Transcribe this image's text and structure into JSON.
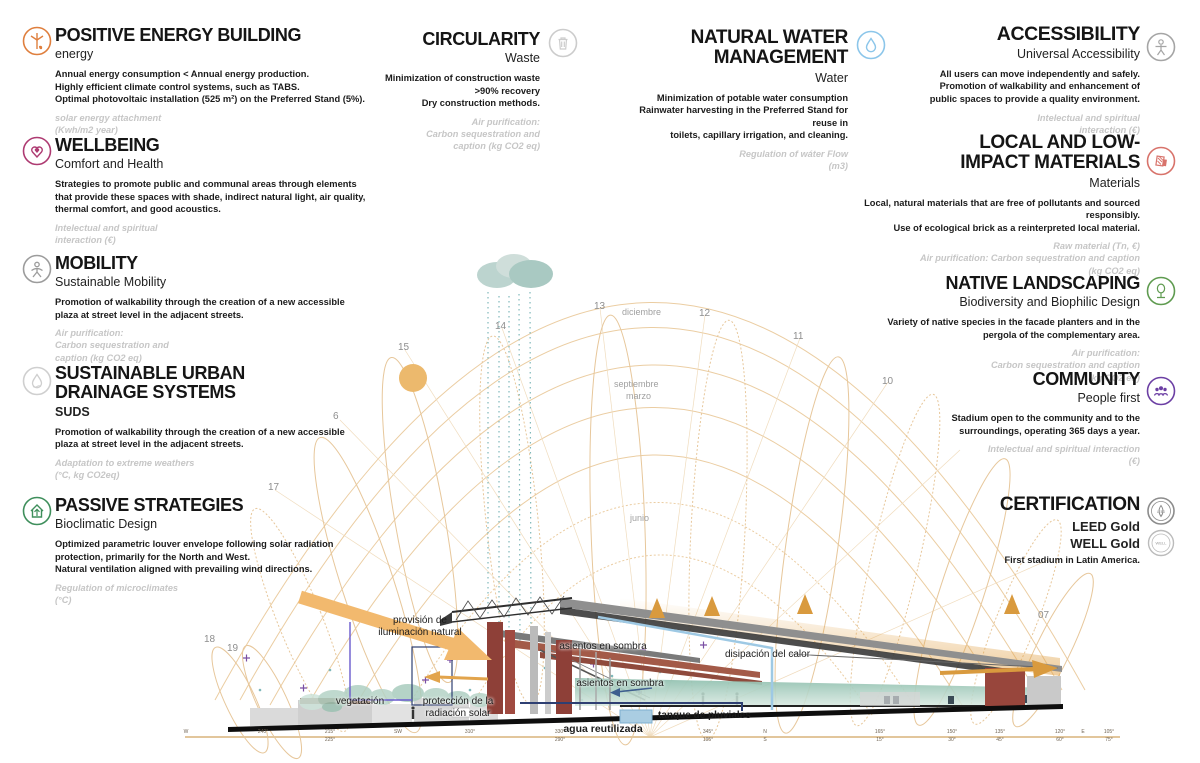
{
  "colors": {
    "energy": "#DF7F3E",
    "wellbeing": "#AE3B72",
    "mobility": "#9C9C9C",
    "suds": "#CFCFCF",
    "passive": "#3F8F5C",
    "circularity": "#CCCCCC",
    "water": "#8CC6EA",
    "accessibility": "#A5A5A5",
    "materials": "#D8736B",
    "landscaping": "#5F9B50",
    "community": "#6C3FA4",
    "certification": "#8C8C8C",
    "sunpath_arc": "#EBCDA2",
    "sun": "#ECB96D",
    "cloud": "#AECBC5",
    "rain": "#7FB8BA",
    "arrow_orange": "#E2A44C",
    "pipe_blue": "#9EC9E4",
    "pipe_navy": "#2E3F72",
    "teal_bowl": "#8FBFAE"
  },
  "sections": {
    "left": [
      {
        "title": "POSITIVE ENERGY BUILDING",
        "subtitle": "energy",
        "body": [
          "Annual energy consumption < Annual energy production.",
          "Highly efficient climate control systems, such as TABS.",
          "Optimal photovoltaic installation (525 m²) on the Preferred Stand (5%)."
        ],
        "metric": [
          "solar energy attachment",
          "(Kwh/m2 year)"
        ]
      },
      {
        "title": "WELLBEING",
        "subtitle": "Comfort and Health",
        "body": [
          "Strategies to promote public and communal areas through elements",
          "that provide these spaces with shade, indirect natural light, air quality,",
          "thermal comfort, and good acoustics."
        ],
        "metric": [
          "Intelectual and spiritual",
          "interaction (€)"
        ]
      },
      {
        "title": "MOBILITY",
        "subtitle": "Sustainable Mobility",
        "body": [
          "Promotion of walkability through the creation of a new accessible",
          "plaza at street level in the adjacent streets."
        ],
        "metric": [
          "Air purification:",
          "Carbon sequestration and",
          "caption (kg CO2 eq)"
        ]
      },
      {
        "title_lines": [
          "SUSTAINABLE URBAN",
          "DRAINAGE SYSTEMS"
        ],
        "subtitle": "SUDS",
        "body": [
          "Promotion of walkability through the creation of a new accessible",
          "plaza at street level in the adjacent streets."
        ],
        "metric": [
          "Adaptation to extreme weathers",
          "(°C, kg CO2eq)"
        ]
      },
      {
        "title": "PASSIVE STRATEGIES",
        "subtitle": "Bioclimatic Design",
        "body": [
          "Optimized parametric louver envelope following solar radiation",
          "protection, primarily for the North and West.",
          "Natural ventilation aligned with prevailing wind directions."
        ],
        "metric": [
          "Regulation of microclimates",
          "(°C)"
        ]
      }
    ],
    "center": [
      {
        "title": "CIRCULARITY",
        "subtitle": "Waste",
        "body": [
          "Minimization of construction waste",
          ">90% recovery",
          "Dry construction methods."
        ],
        "metric": [
          "Air purification:",
          "Carbon sequestration and",
          "caption (kg CO2 eq)"
        ]
      },
      {
        "title_lines": [
          "NATURAL WATER",
          "MANAGEMENT"
        ],
        "subtitle": "Water",
        "body": [
          "Minimization of potable water consumption",
          "Rainwater harvesting in the Preferred Stand for reuse in",
          "toilets, capillary irrigation, and cleaning."
        ],
        "metric": [
          "Regulation of wáter Flow",
          "(m3)"
        ]
      }
    ],
    "right": [
      {
        "title": "ACCESSIBILITY",
        "subtitle": "Universal Accessibility",
        "body": [
          "All users can move independently and safely.",
          "Promotion of walkability and enhancement of",
          "public spaces to provide a quality environment."
        ],
        "metric": [
          "Intelectual and spiritual",
          "interaction (€)"
        ]
      },
      {
        "title_lines": [
          "LOCAL AND LOW-",
          "IMPACT MATERIALS"
        ],
        "subtitle": "Materials",
        "body": [
          "Local, natural materials that are free of pollutants and sourced responsibly.",
          "Use of ecological brick as a reinterpreted local material."
        ],
        "metric": [
          "Raw material (Tn, €)",
          "Air purification: Carbon sequestration and caption",
          "(kg CO2 eq)"
        ]
      },
      {
        "title": "NATIVE LANDSCAPING",
        "subtitle": "Biodiversity and Biophilic Design",
        "body": [
          "Variety of native species in the facade planters and in the",
          "pergola of the complementary area."
        ],
        "metric": [
          "Air purification:",
          "Carbon sequestration and caption",
          "(kg CO2 eq)"
        ]
      },
      {
        "title": "COMMUNITY",
        "subtitle": "People first",
        "body": [
          "Stadium open to the community and to the",
          "surroundings, operating 365 days a year."
        ],
        "metric": [
          "Intelectual and spiritual interaction",
          "(€)"
        ]
      },
      {
        "title": "CERTIFICATION",
        "lines": [
          "LEED Gold",
          "WELL Gold"
        ],
        "note": "First stadium in Latin America.",
        "badges": [
          "LEED",
          "WELL"
        ]
      }
    ]
  },
  "diagram": {
    "labels": {
      "natural_light": [
        "provisión de",
        "iluminación natural"
      ],
      "shade_upper": "asientos en sombra",
      "shade_lower": "asientos en sombra",
      "heat": "disipación del calor",
      "protection": [
        "protección de la",
        "radiación solar"
      ],
      "vegetation": "vegetación",
      "tank": "tanque de pluviales",
      "reused_water": "agua reutilizada"
    },
    "months": [
      {
        "text": "diciembre",
        "x": 622,
        "y": 307
      },
      {
        "text": "septiembre",
        "x": 614,
        "y": 379
      },
      {
        "text": "marzo",
        "x": 626,
        "y": 391
      },
      {
        "text": "junio",
        "x": 630,
        "y": 513
      }
    ],
    "hours": [
      {
        "text": "6",
        "x": 333,
        "y": 411
      },
      {
        "text": "15",
        "x": 398,
        "y": 342
      },
      {
        "text": "14",
        "x": 495,
        "y": 321
      },
      {
        "text": "13",
        "x": 594,
        "y": 301
      },
      {
        "text": "12",
        "x": 699,
        "y": 308
      },
      {
        "text": "11",
        "x": 793,
        "y": 331
      },
      {
        "text": "10",
        "x": 882,
        "y": 376
      },
      {
        "text": "17",
        "x": 268,
        "y": 482
      },
      {
        "text": "18",
        "x": 204,
        "y": 634
      },
      {
        "text": "19",
        "x": 227,
        "y": 643
      },
      {
        "text": "07",
        "x": 1038,
        "y": 610
      }
    ],
    "compass_ticks": [
      {
        "x": 186,
        "top": "W",
        "bot": ""
      },
      {
        "x": 263,
        "top": "",
        "bot": "240°"
      },
      {
        "x": 330,
        "top": "215°",
        "bot": "225°"
      },
      {
        "x": 398,
        "top": "",
        "bot": "SW"
      },
      {
        "x": 470,
        "top": "310°",
        "bot": ""
      },
      {
        "x": 560,
        "top": "330°",
        "bot": "290°"
      },
      {
        "x": 708,
        "top": "345°",
        "bot": "195°"
      },
      {
        "x": 765,
        "top": "N",
        "bot": "S"
      },
      {
        "x": 880,
        "top": "165°",
        "bot": "15°"
      },
      {
        "x": 952,
        "top": "150°",
        "bot": "30°"
      },
      {
        "x": 1000,
        "top": "135°",
        "bot": "45°"
      },
      {
        "x": 1060,
        "top": "120°",
        "bot": "60°"
      },
      {
        "x": 1083,
        "top": "E",
        "bot": ""
      },
      {
        "x": 1109,
        "top": "105°",
        "bot": "75°"
      }
    ]
  }
}
